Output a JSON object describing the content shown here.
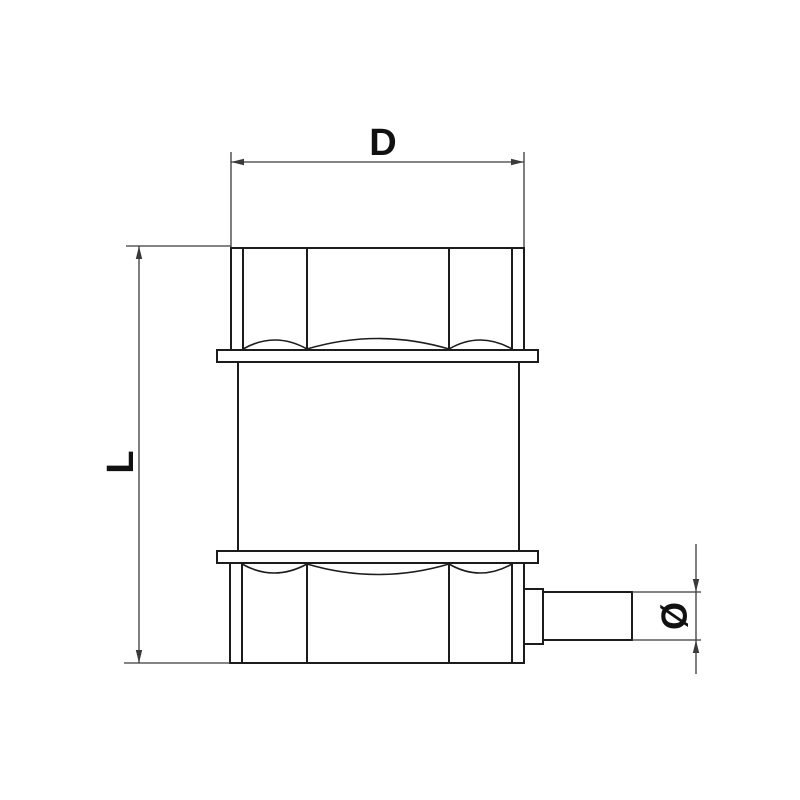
{
  "labels": {
    "d_dimension": "D",
    "l_dimension": "L",
    "diameter_symbol": "Ø"
  },
  "colors": {
    "background": "#ffffff",
    "object_line": "#1c1c1c",
    "dimension_line": "#3a3a3a",
    "label_color": "#111111"
  }
}
